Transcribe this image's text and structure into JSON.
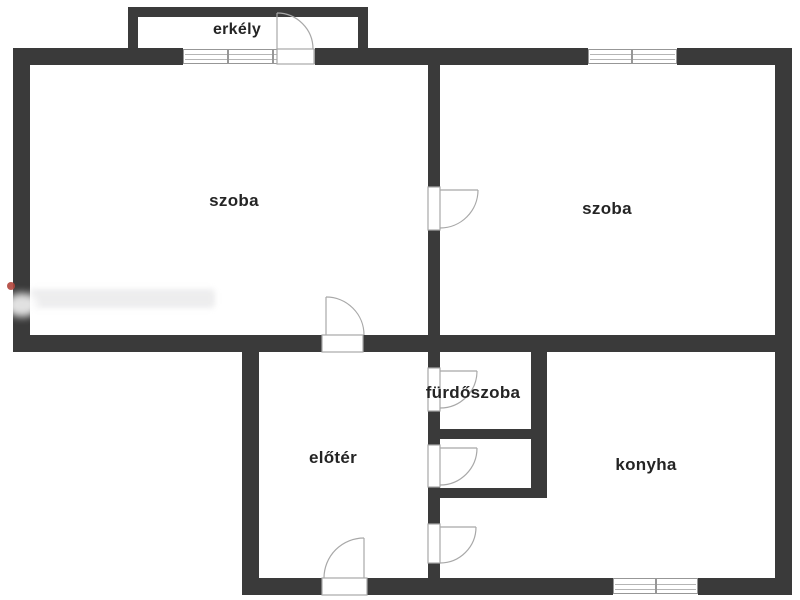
{
  "diagram": {
    "type": "floor-plan",
    "language": "hu",
    "rooms": {
      "balcony": {
        "label": "erkély"
      },
      "room_left": {
        "label": "szoba"
      },
      "room_right": {
        "label": "szoba"
      },
      "bathroom": {
        "label": "fürdőszoba"
      },
      "hall": {
        "label": "előtér"
      },
      "kitchen": {
        "label": "konyha"
      }
    },
    "colors": {
      "wall": "#3a3a3a",
      "door_window_line": "#a8a8a8",
      "text": "#242424",
      "background": "#ffffff",
      "marker_dot": "#b0453c"
    }
  }
}
